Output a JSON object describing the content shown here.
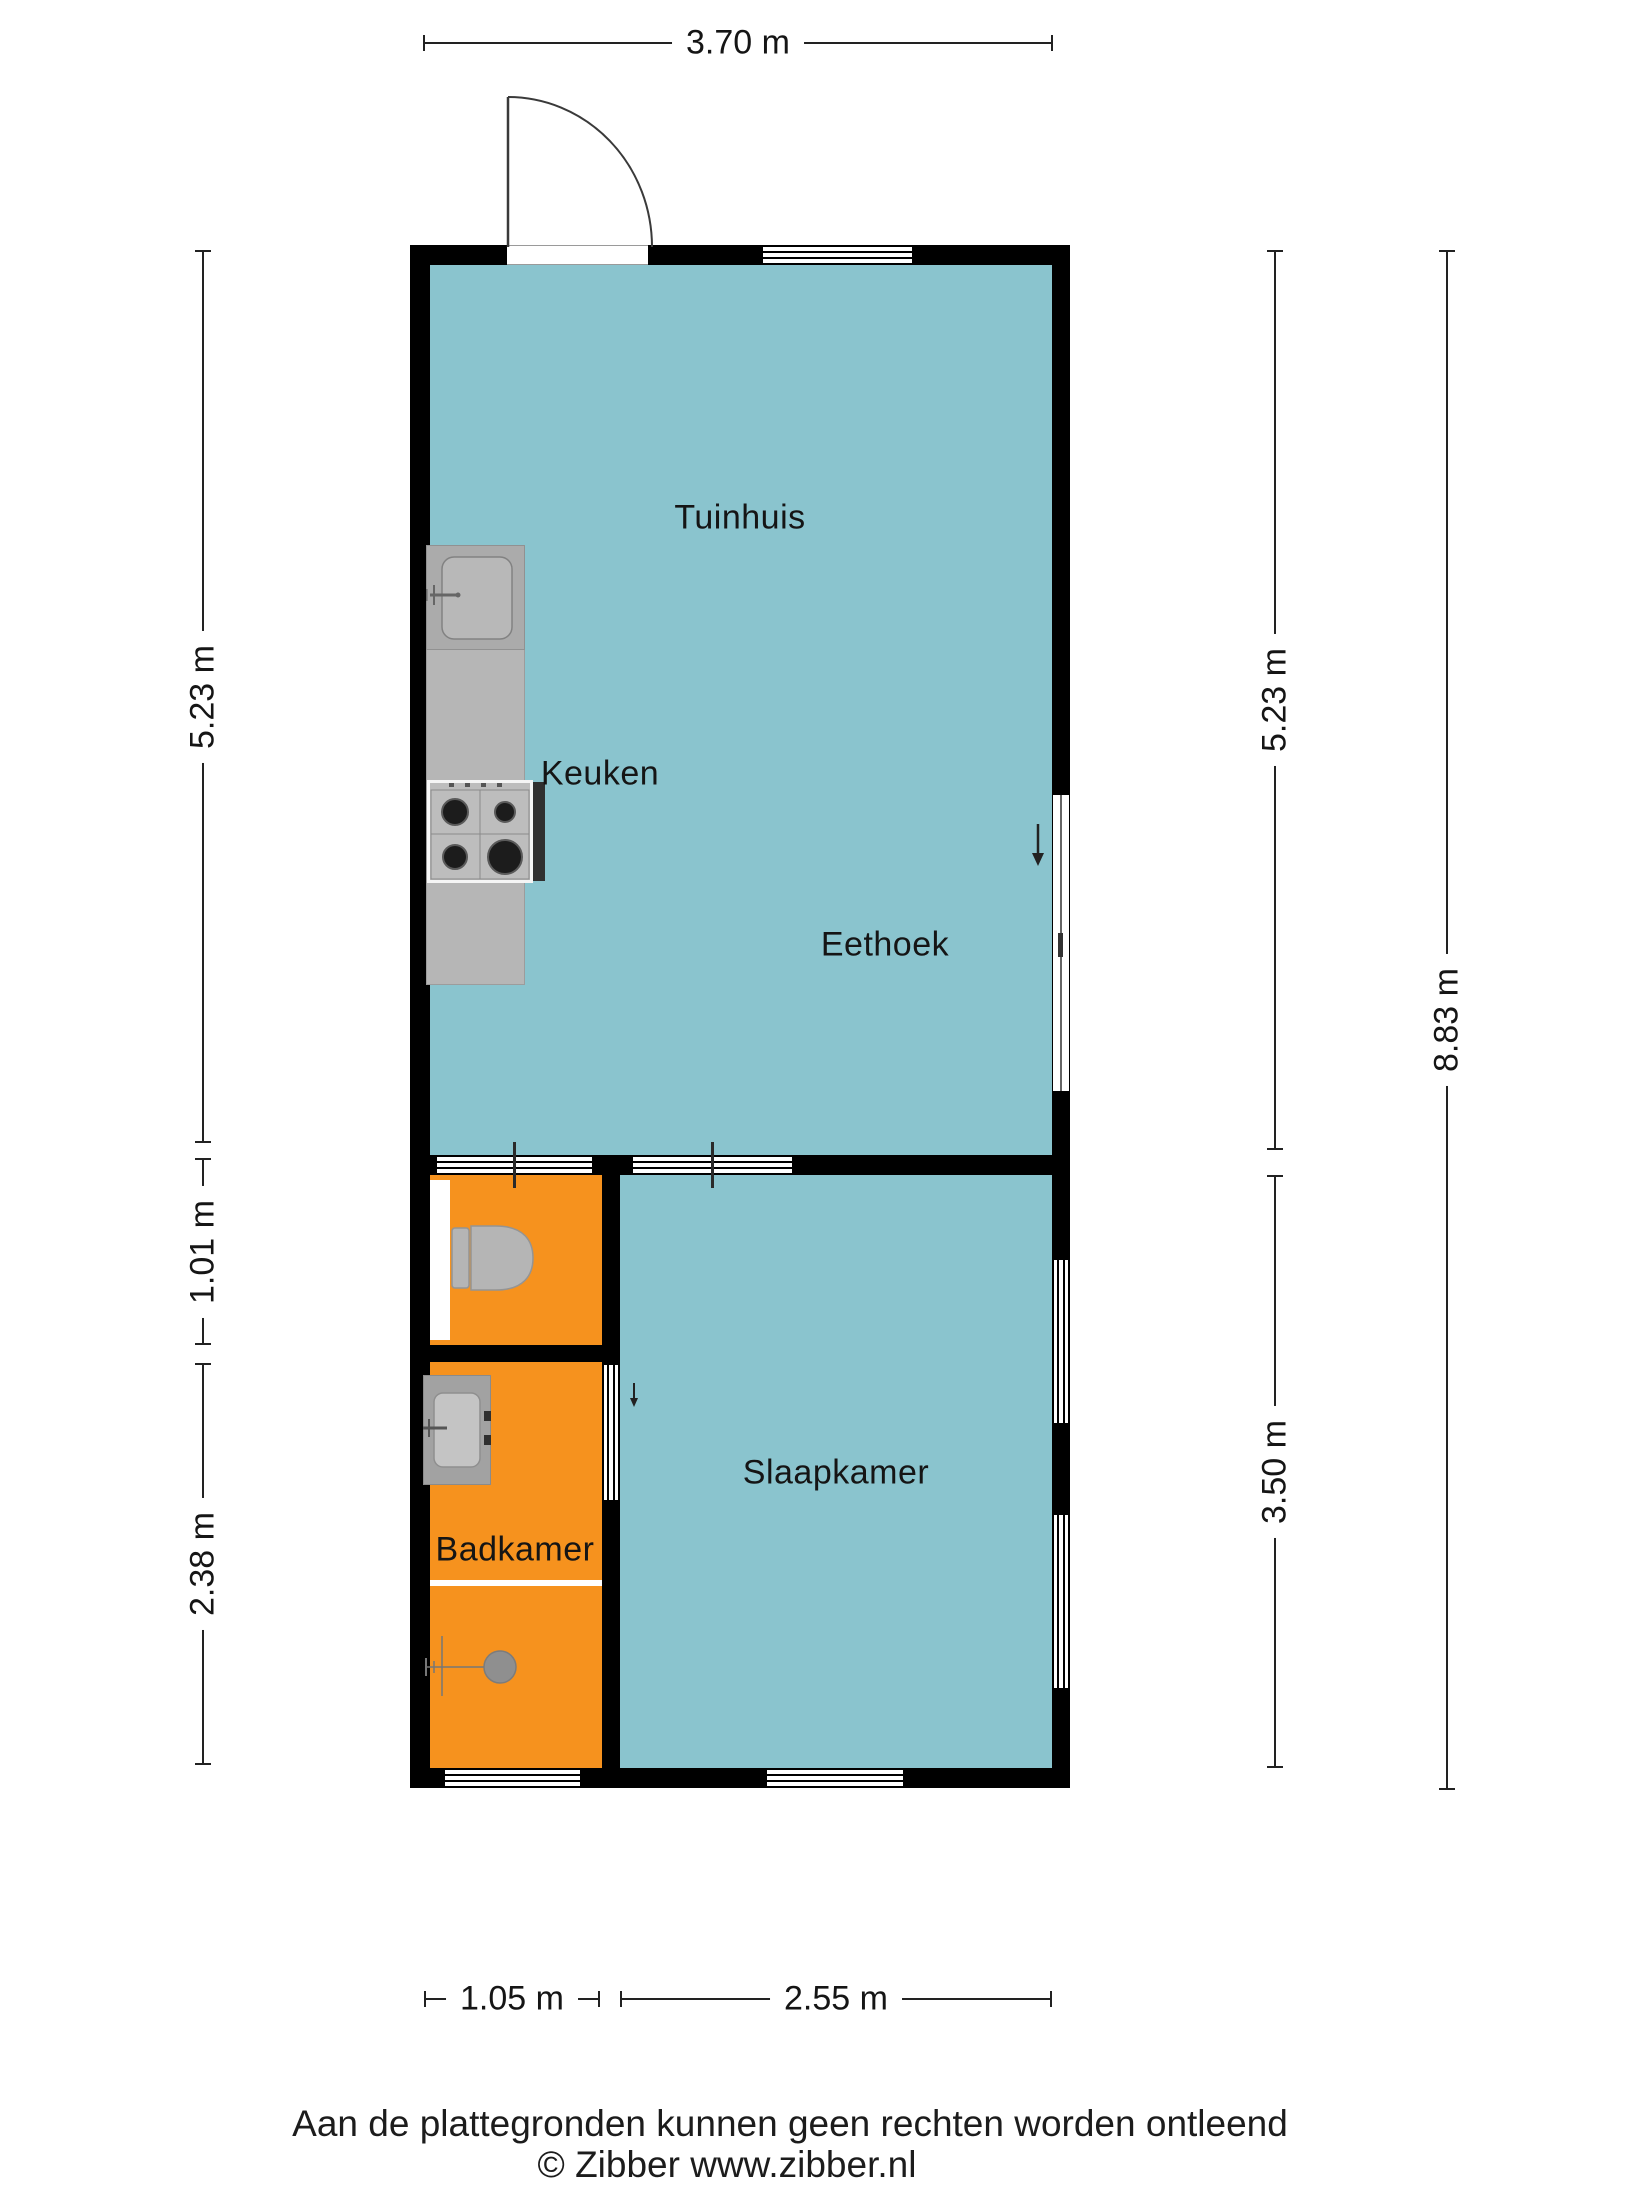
{
  "plan": {
    "rooms": {
      "tuinhuis": {
        "label": "Tuinhuis"
      },
      "keuken": {
        "label": "Keuken"
      },
      "eethoek": {
        "label": "Eethoek"
      },
      "badkamer": {
        "label": "Badkamer"
      },
      "slaapkamer": {
        "label": "Slaapkamer"
      }
    },
    "dimensions": {
      "top_width": "3.70 m",
      "left_upper": "5.23 m",
      "left_middle": "1.01 m",
      "left_lower": "2.38 m",
      "right_upper": "5.23 m",
      "right_lower": "3.50 m",
      "right_total": "8.83 m",
      "bottom_left": "1.05 m",
      "bottom_right": "2.55 m"
    },
    "colors": {
      "living_floor": "#8AC4CE",
      "bathroom_floor": "#F6921E",
      "wall": "#000000"
    },
    "fixtures": [
      "kitchen-sink",
      "kitchen-counter",
      "stove",
      "toilet",
      "bathroom-sink",
      "shower"
    ]
  },
  "footer": {
    "disclaimer": "Aan de plattegronden kunnen geen rechten worden ontleend",
    "credit": "© Zibber www.zibber.nl"
  }
}
